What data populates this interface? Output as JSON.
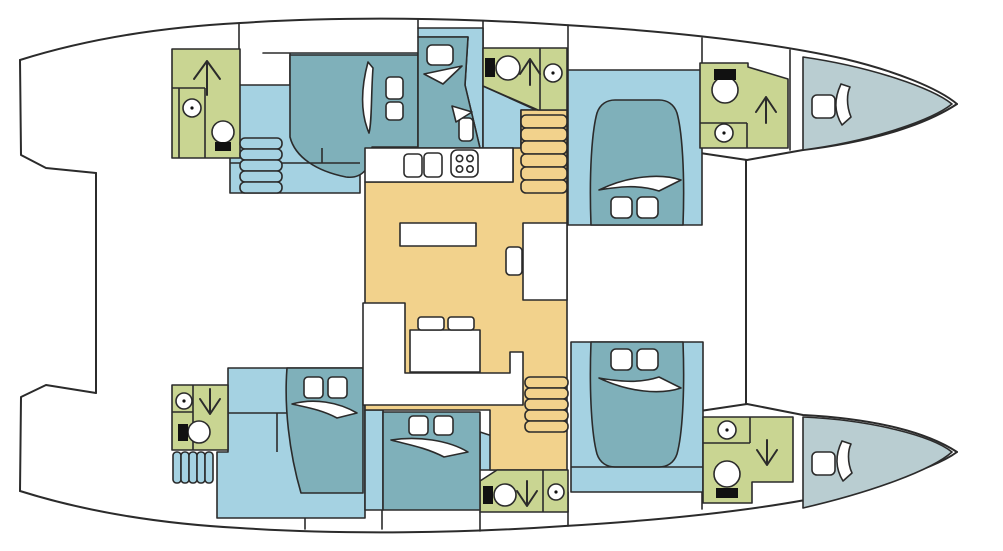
{
  "diagram": {
    "type": "yacht-floorplan",
    "subject": "catamaran-deck-plan-top-view-bow-right",
    "colors": {
      "outline": "#2b2b2b",
      "bathroom": "#c9d592",
      "cabin_floor": "#a5d2e2",
      "bed": "#7fb0ba",
      "salon": "#f2d28c",
      "forepeak_berth": "#b9cdd1",
      "white": "#ffffff",
      "black": "#111111"
    },
    "layout_summary": {
      "double_cabins": 4,
      "single_berths": 2,
      "forepeak_berths": 2,
      "bathrooms": 6,
      "salon_galley": 1,
      "nav_station": 1,
      "companionway_stairs": 4
    },
    "fixture_icons": [
      "toilet-icon",
      "washbasin-icon",
      "shower-arrow-icon",
      "double-berth-icon",
      "single-berth-icon",
      "pillow-icon",
      "duvet-fold-icon",
      "galley-sink-icon",
      "stove-icon",
      "galley-counter-icon",
      "dining-table-icon",
      "settee-icon",
      "nav-seat-icon",
      "stair-treads-icon"
    ]
  }
}
